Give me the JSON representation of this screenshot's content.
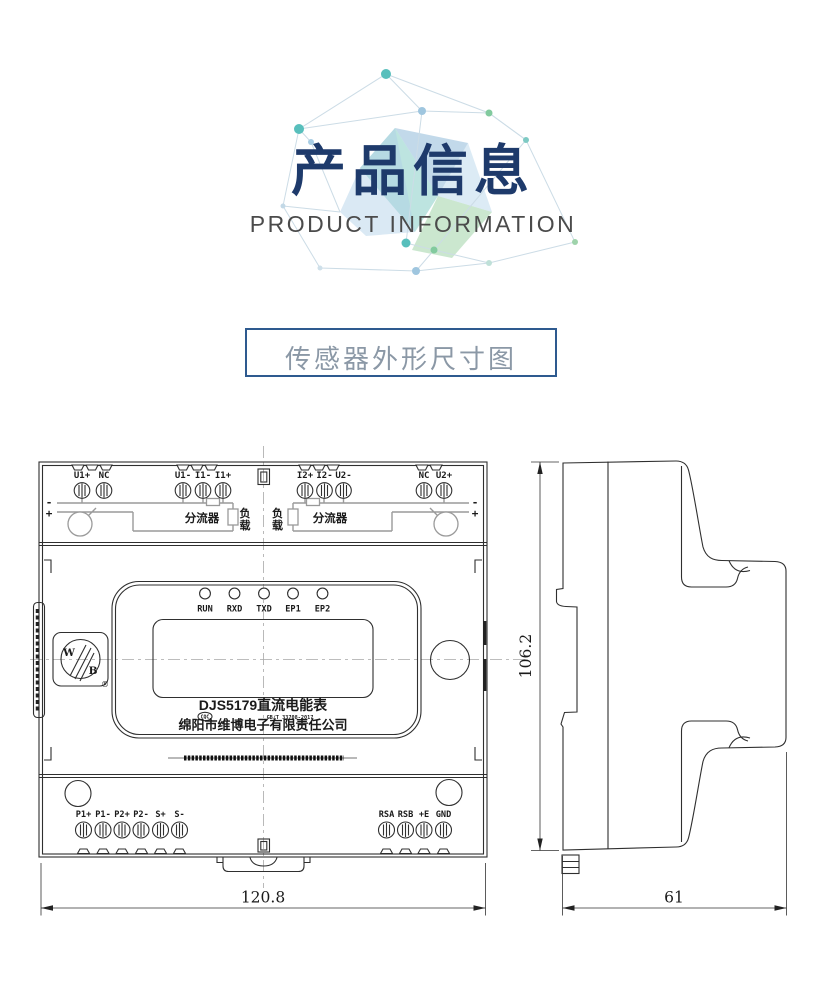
{
  "header": {
    "title": "产品信息",
    "subtitle": "PRODUCT INFORMATION"
  },
  "section_box": {
    "label": "传感器外形尺寸图"
  },
  "colors": {
    "title_navy": "#1e3a6b",
    "subtitle_gray": "#4b4b4b",
    "box_border_blue": "#2e5a8f",
    "box_text_gray": "#8b98a6",
    "accent_teal": "#58bfbc",
    "accent_green": "#82ca9e",
    "accent_blue": "#9fc6df",
    "drawing_line": "#2f2f2f",
    "wire_gray": "#9a9a9a"
  },
  "front_view": {
    "top_terminals": [
      "U1+",
      "NC",
      "U1-",
      "I1-",
      "I1+",
      "I2+",
      "I2-",
      "U2-",
      "NC",
      "U2+"
    ],
    "wiring": {
      "shunt": "分流器",
      "load": "负载",
      "minus": "-",
      "plus": "+"
    },
    "leds": [
      "RUN",
      "RXD",
      "TXD",
      "EP1",
      "EP2"
    ],
    "product_name": "DJS5179直流电能表",
    "cert_mark": "CQC",
    "standard": "GB/T 33708-2017",
    "company": "绵阳市维博电子有限责任公司",
    "logo": {
      "w": "W",
      "b": "B",
      "registered": "®"
    },
    "bottom_terminals": [
      "P1+",
      "P1-",
      "P2+",
      "P2-",
      "S+",
      "S-",
      "RSA",
      "RSB",
      "+E",
      "GND"
    ]
  },
  "dimensions": {
    "width": "120.8",
    "height": "106.2",
    "depth": "61"
  }
}
